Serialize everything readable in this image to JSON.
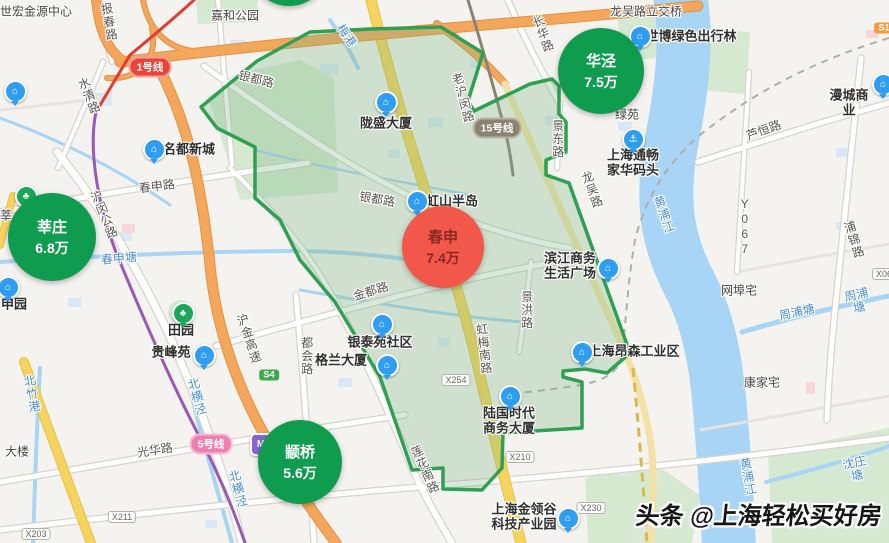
{
  "watermark": {
    "text": "头条 @上海轻松买好房"
  },
  "colors": {
    "bubble_green": "#109C4F",
    "bubble_red": "#F2574B",
    "bubble_red_text": "#8B2A22",
    "region_fill": "rgba(121,183,131,0.30)",
    "region_stroke": "#2FA053",
    "water": "#A8D4F5"
  },
  "price_bubbles": [
    {
      "name": "莘庄",
      "price": "6.8万",
      "x": 52,
      "y": 237,
      "r": 44,
      "color": "#109C4F",
      "text_color": "#FFFFFF",
      "partial": false
    },
    {
      "name": "春申",
      "price": "7.4万",
      "x": 443,
      "y": 247,
      "r": 41,
      "color": "#F2574B",
      "text_color": "#8B2A22",
      "partial": false
    },
    {
      "name": "华泾",
      "price": "7.5万",
      "x": 601,
      "y": 71,
      "r": 43,
      "color": "#109C4F",
      "text_color": "#FFFFFF",
      "partial": false
    },
    {
      "name": "颛桥",
      "price": "5.6万",
      "x": 300,
      "y": 462,
      "r": 42,
      "color": "#109C4F",
      "text_color": "#FFFFFF",
      "partial": false
    },
    {
      "name": "",
      "price": "",
      "x": 289,
      "y": -34,
      "r": 40,
      "color": "#109C4F",
      "text_color": "#FFFFFF",
      "partial": true
    }
  ],
  "metro_badges": [
    {
      "label": "1号线",
      "x": 150,
      "y": 67,
      "bg": "#E8453A",
      "border": "#F2A09A"
    },
    {
      "label": "15号线",
      "x": 497,
      "y": 128,
      "bg": "#8B8272",
      "border": "#BAB3A5"
    },
    {
      "label": "5号线",
      "x": 211,
      "y": 444,
      "bg": "#EF7FAE",
      "border": "#F7BCD4"
    }
  ],
  "road_badges": [
    {
      "label": "X254",
      "x": 456,
      "y": 380
    },
    {
      "label": "X210",
      "x": 520,
      "y": 457
    },
    {
      "label": "X230",
      "x": 591,
      "y": 508
    },
    {
      "label": "X211",
      "x": 122,
      "y": 517
    },
    {
      "label": "X203",
      "x": 36,
      "y": 534
    },
    {
      "label": "X06",
      "x": 884,
      "y": 274
    }
  ],
  "expressway_badges": [
    {
      "label": "S4",
      "x": 269,
      "y": 375,
      "bg": "#3CAB4E"
    },
    {
      "label": "S1",
      "x": 884,
      "y": 28,
      "bg": "#F59B3C"
    }
  ],
  "road_labels": [
    {
      "text": "报春路",
      "x": 108,
      "y": 22,
      "rot": 80
    },
    {
      "text": "水清路",
      "x": 88,
      "y": 96,
      "rot": 68
    },
    {
      "text": "春申路",
      "x": 157,
      "y": 187,
      "rot": -7
    },
    {
      "text": "沪闵公路",
      "x": 103,
      "y": 215,
      "rot": 68
    },
    {
      "text": "银都路",
      "x": 256,
      "y": 80,
      "rot": 14
    },
    {
      "text": "银都路",
      "x": 377,
      "y": 200,
      "rot": 10
    },
    {
      "text": "金都路",
      "x": 371,
      "y": 292,
      "rot": -17
    },
    {
      "text": "沪金高速",
      "x": 248,
      "y": 339,
      "rot": 72
    },
    {
      "text": "都会路",
      "x": 306,
      "y": 356,
      "rot": 90
    },
    {
      "text": "莲花南路",
      "x": 424,
      "y": 470,
      "rot": 66
    },
    {
      "text": "虹梅南路",
      "x": 483,
      "y": 349,
      "rot": 84
    },
    {
      "text": "景洪路",
      "x": 526,
      "y": 310,
      "rot": 90
    },
    {
      "text": "景东路",
      "x": 557,
      "y": 139,
      "rot": 90
    },
    {
      "text": "龙吴路",
      "x": 591,
      "y": 190,
      "rot": 70
    },
    {
      "text": "长华路",
      "x": 542,
      "y": 34,
      "rot": 70
    },
    {
      "text": "老沪闵路",
      "x": 462,
      "y": 98,
      "rot": 75
    },
    {
      "text": "芦恒路",
      "x": 764,
      "y": 131,
      "rot": -20
    },
    {
      "text": "Y067",
      "x": 744,
      "y": 227,
      "rot": 90
    },
    {
      "text": "浦锦路",
      "x": 853,
      "y": 240,
      "rot": 72
    },
    {
      "text": "光华路",
      "x": 155,
      "y": 451,
      "rot": -9
    }
  ],
  "water_labels": [
    {
      "text": "春申塘",
      "x": 119,
      "y": 259,
      "rot": -5
    },
    {
      "text": "北竹港",
      "x": 31,
      "y": 394,
      "rot": 80
    },
    {
      "text": "北横泾",
      "x": 196,
      "y": 397,
      "rot": 75
    },
    {
      "text": "北横泾",
      "x": 237,
      "y": 489,
      "rot": 75
    },
    {
      "text": "黄浦江",
      "x": 663,
      "y": 215,
      "rot": 72
    },
    {
      "text": "黄浦江",
      "x": 747,
      "y": 477,
      "rot": 80
    },
    {
      "text": "周浦塘",
      "x": 797,
      "y": 313,
      "rot": -13
    },
    {
      "text": "周浦塘",
      "x": 858,
      "y": 302,
      "rot": -13
    },
    {
      "text": "沈庄塘",
      "x": 856,
      "y": 470,
      "rot": -13
    },
    {
      "text": "梅港",
      "x": 346,
      "y": 36,
      "rot": 55
    }
  ],
  "place_labels": [
    {
      "text": "世宏金源中心",
      "x": 36,
      "y": 12
    },
    {
      "text": "嘉和公园",
      "x": 235,
      "y": 16
    },
    {
      "text": "龙吴路立交桥",
      "x": 646,
      "y": 12
    },
    {
      "text": "康家宅",
      "x": 762,
      "y": 383
    },
    {
      "text": "网埠宅",
      "x": 739,
      "y": 291
    },
    {
      "text": "大楼",
      "x": 17,
      "y": 452
    },
    {
      "text": "莘",
      "x": 6,
      "y": 216
    },
    {
      "text": "绿苑",
      "x": 627,
      "y": 115
    }
  ],
  "pois": [
    {
      "label": "名都新城",
      "icon": "building",
      "ix": 152,
      "iy": 149,
      "lx": 189,
      "ly": 150,
      "style": "blue"
    },
    {
      "label": "申园",
      "icon": "building",
      "ix": 6,
      "iy": 287,
      "lx": 14,
      "ly": 305,
      "style": "blue"
    },
    {
      "label": "田园",
      "icon": "park",
      "ix": 181,
      "iy": 313,
      "lx": 181,
      "ly": 331,
      "style": "green"
    },
    {
      "label": "贵峰苑",
      "icon": "building",
      "ix": 202,
      "iy": 355,
      "lx": 171,
      "ly": 353,
      "style": "blue"
    },
    {
      "label": "陇盛大厦",
      "icon": "building",
      "ix": 384,
      "iy": 102,
      "lx": 386,
      "ly": 124,
      "style": "blue"
    },
    {
      "label": "虹山半岛",
      "icon": "building",
      "ix": 415,
      "iy": 201,
      "lx": 452,
      "ly": 202,
      "style": "blue"
    },
    {
      "label": "银泰苑社区",
      "icon": "building",
      "ix": 380,
      "iy": 324,
      "lx": 380,
      "ly": 343,
      "style": "blue"
    },
    {
      "label": "格兰大厦",
      "icon": "building",
      "ix": 385,
      "iy": 365,
      "lx": 341,
      "ly": 361,
      "style": "blue"
    },
    {
      "label": "滨江商务\n生活广场",
      "icon": "building",
      "ix": 606,
      "iy": 268,
      "lx": 570,
      "ly": 266,
      "style": "blue"
    },
    {
      "label": "上海昂森工业区",
      "icon": "building",
      "ix": 580,
      "iy": 352,
      "lx": 634,
      "ly": 352,
      "style": "blue"
    },
    {
      "label": "陆国时代\n商务大厦",
      "icon": "building",
      "ix": 508,
      "iy": 396,
      "lx": 509,
      "ly": 421,
      "style": "blue"
    },
    {
      "label": "上海金领谷\n科技产业园",
      "icon": "building",
      "ix": 566,
      "iy": 518,
      "lx": 524,
      "ly": 517,
      "style": "blue"
    },
    {
      "label": "世博绿色出行林",
      "icon": "building",
      "ix": 638,
      "iy": 36,
      "lx": 691,
      "ly": 37,
      "style": "blue"
    },
    {
      "label": "上海通畅\n家华码头",
      "icon": "anchor",
      "ix": 631,
      "iy": 139,
      "lx": 633,
      "ly": 163,
      "style": "blue"
    },
    {
      "label": "漫城商业",
      "icon": "building",
      "ix": 881,
      "iy": 84,
      "lx": 849,
      "ly": 103,
      "style": "blue"
    },
    {
      "label": "",
      "icon": "school",
      "ix": 13,
      "iy": 91,
      "lx": 0,
      "ly": 0,
      "style": "blue"
    },
    {
      "label": "",
      "icon": "park",
      "ix": 24,
      "iy": 196,
      "lx": 0,
      "ly": 0,
      "style": "green"
    },
    {
      "label": "",
      "icon": "metro",
      "ix": 259,
      "iy": 444,
      "lx": 0,
      "ly": 0,
      "style": "purple"
    }
  ],
  "icon_glyphs": {
    "building": "⌂",
    "anchor": "⚓",
    "park": "♣",
    "school": "⌂",
    "metro": "M"
  }
}
